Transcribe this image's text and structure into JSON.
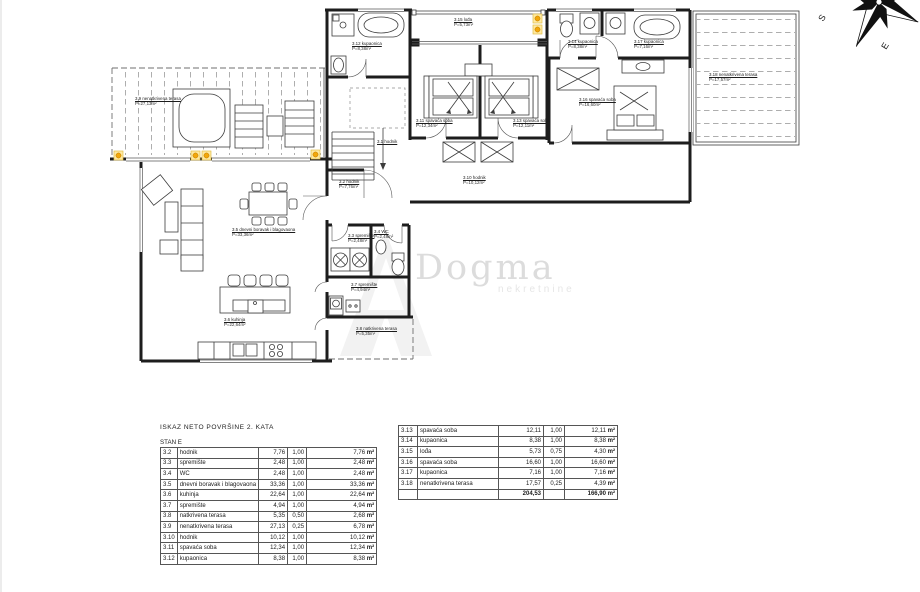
{
  "compass": {
    "s": "S",
    "e": "E"
  },
  "watermark": {
    "name": "Dogma",
    "tagline": "nekretnine"
  },
  "plan": {
    "labels": [
      {
        "x": 133,
        "y": 96,
        "t": "3.9 nenatkrivena terasa",
        "a": "P=27,13m²"
      },
      {
        "x": 230,
        "y": 227,
        "t": "3.5 dnevni boravak i blagovaona",
        "a": "P=33,36m²"
      },
      {
        "x": 222,
        "y": 317,
        "t": "3.6 kuhinja",
        "a": "P=22,64m²"
      },
      {
        "x": 337,
        "y": 179,
        "t": "3.2 hodnik",
        "a": "P=7,76m²"
      },
      {
        "x": 375,
        "y": 139,
        "t": "3.1 hodnik",
        "a": ""
      },
      {
        "x": 350,
        "y": 41,
        "t": "3.12 kupaonica",
        "a": "P=8,38m²"
      },
      {
        "x": 452,
        "y": 17,
        "t": "3.15 lođa",
        "a": "P=5,73m²"
      },
      {
        "x": 414,
        "y": 118,
        "t": "3.11 spavaća soba",
        "a": "P=12,34m²"
      },
      {
        "x": 511,
        "y": 118,
        "t": "3.13 spavaća soba",
        "a": "P=12,11m²"
      },
      {
        "x": 461,
        "y": 175,
        "t": "3.10 hodnik",
        "a": "P=10,12m²"
      },
      {
        "x": 566,
        "y": 39,
        "t": "3.14 kupaonica",
        "a": "P=8,38m²"
      },
      {
        "x": 632,
        "y": 39,
        "t": "3.17 kupaonica",
        "a": "P=7,16m²"
      },
      {
        "x": 577,
        "y": 97,
        "t": "3.16 spavaća soba",
        "a": "P=16,60m²"
      },
      {
        "x": 707,
        "y": 72,
        "t": "3.18 nenatkrivena terasa",
        "a": "P=17,57m²"
      },
      {
        "x": 346,
        "y": 233,
        "t": "3.3 spremište",
        "a": "P=2,48m²"
      },
      {
        "x": 372,
        "y": 229,
        "t": "3.4 WC",
        "a": "P=2,48m²"
      },
      {
        "x": 349,
        "y": 282,
        "t": "3.7 spremište",
        "a": "P=4,94m²"
      },
      {
        "x": 354,
        "y": 326,
        "t": "3.8 natkrivena terasa",
        "a": "P=5,35m²"
      }
    ]
  },
  "tables": {
    "title": "ISKAZ  NETO POVRŠINE 2. KATA",
    "unit": "m²",
    "left": {
      "subtitle": "STAN E",
      "rows": [
        [
          "3.2",
          "hodnik",
          "7,76",
          "1,00",
          "7,76"
        ],
        [
          "3.3",
          "spremište",
          "2,48",
          "1,00",
          "2,48"
        ],
        [
          "3.4",
          "WC",
          "2,48",
          "1,00",
          "2,48"
        ],
        [
          "3.5",
          "dnevni boravak i blagovaona",
          "33,36",
          "1,00",
          "33,36"
        ],
        [
          "3.6",
          "kuhinja",
          "22,64",
          "1,00",
          "22,64"
        ],
        [
          "3.7",
          "spremište",
          "4,94",
          "1,00",
          "4,94"
        ],
        [
          "3.8",
          "natkrivena terasa",
          "5,35",
          "0,50",
          "2,68"
        ],
        [
          "3.9",
          "nenatkrivena terasa",
          "27,13",
          "0,25",
          "6,78"
        ],
        [
          "3.10",
          "hodnik",
          "10,12",
          "1,00",
          "10,12"
        ],
        [
          "3.11",
          "spavaća soba",
          "12,34",
          "1,00",
          "12,34"
        ],
        [
          "3.12",
          "kupaonica",
          "8,38",
          "1,00",
          "8,38"
        ]
      ]
    },
    "right": {
      "rows": [
        [
          "3.13",
          "spavaća soba",
          "12,11",
          "1,00",
          "12,11"
        ],
        [
          "3.14",
          "kupaonica",
          "8,38",
          "1,00",
          "8,38"
        ],
        [
          "3.15",
          "lođa",
          "5,73",
          "0,75",
          "4,30"
        ],
        [
          "3.16",
          "spavaća soba",
          "16,60",
          "1,00",
          "16,60"
        ],
        [
          "3.17",
          "kupaonica",
          "7,16",
          "1,00",
          "7,16"
        ],
        [
          "3.18",
          "nenatkrivena terasa",
          "17,57",
          "0,25",
          "4,39"
        ]
      ],
      "total": {
        "sum": "204,53",
        "result": "166,90"
      }
    }
  }
}
